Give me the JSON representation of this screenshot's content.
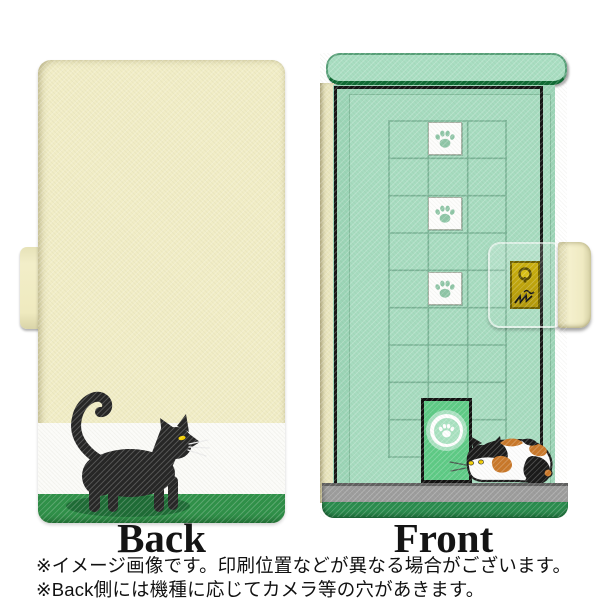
{
  "product": {
    "type_label": "phone flip case product mockup",
    "labels": {
      "back": "Back",
      "front": "Front"
    },
    "notes": {
      "line1": "※イメージ画像です。印刷位置などが異なる場合がございます。",
      "line2": "※Back側には機種に応じてカメラ等の穴があきます。"
    },
    "design": {
      "back_illustration": "black cat walking on cream, white and green stripes",
      "front_illustration": "green door with grid, 3 white paw-print tiles, pet door with paw circle, calico cat, gold keyhole clasp",
      "paw_tiles": 3,
      "icons": [
        "paw-print-icon",
        "keyhole-icon",
        "claw-scratch-icon"
      ]
    }
  },
  "colors": {
    "case-cream": "#f1edc6",
    "band-white": "#fbfbf8",
    "band-green": "#2f9149",
    "shadow-green": "#1d6b35",
    "cap-green": "#a9dec2",
    "cap-edge": "#0e6a33",
    "face-green": "#9cd5b7",
    "panel-green": "#a7dcc0",
    "grid-line": "#6fa98c",
    "tile-paw": "#8fc6a7",
    "petdoor-green": "#5ecb86",
    "petdoor-circle": "#a9e2c1",
    "floor-gray": "#9d9d9d",
    "floor-edge": "#5f5f5f",
    "bottom-green": "#2a8c4e",
    "gold-border": "#6f6000",
    "cat-black": "#262626",
    "eye-yellow": "#f5d000",
    "calico-orange": "#c9782a",
    "text": "#111111"
  }
}
